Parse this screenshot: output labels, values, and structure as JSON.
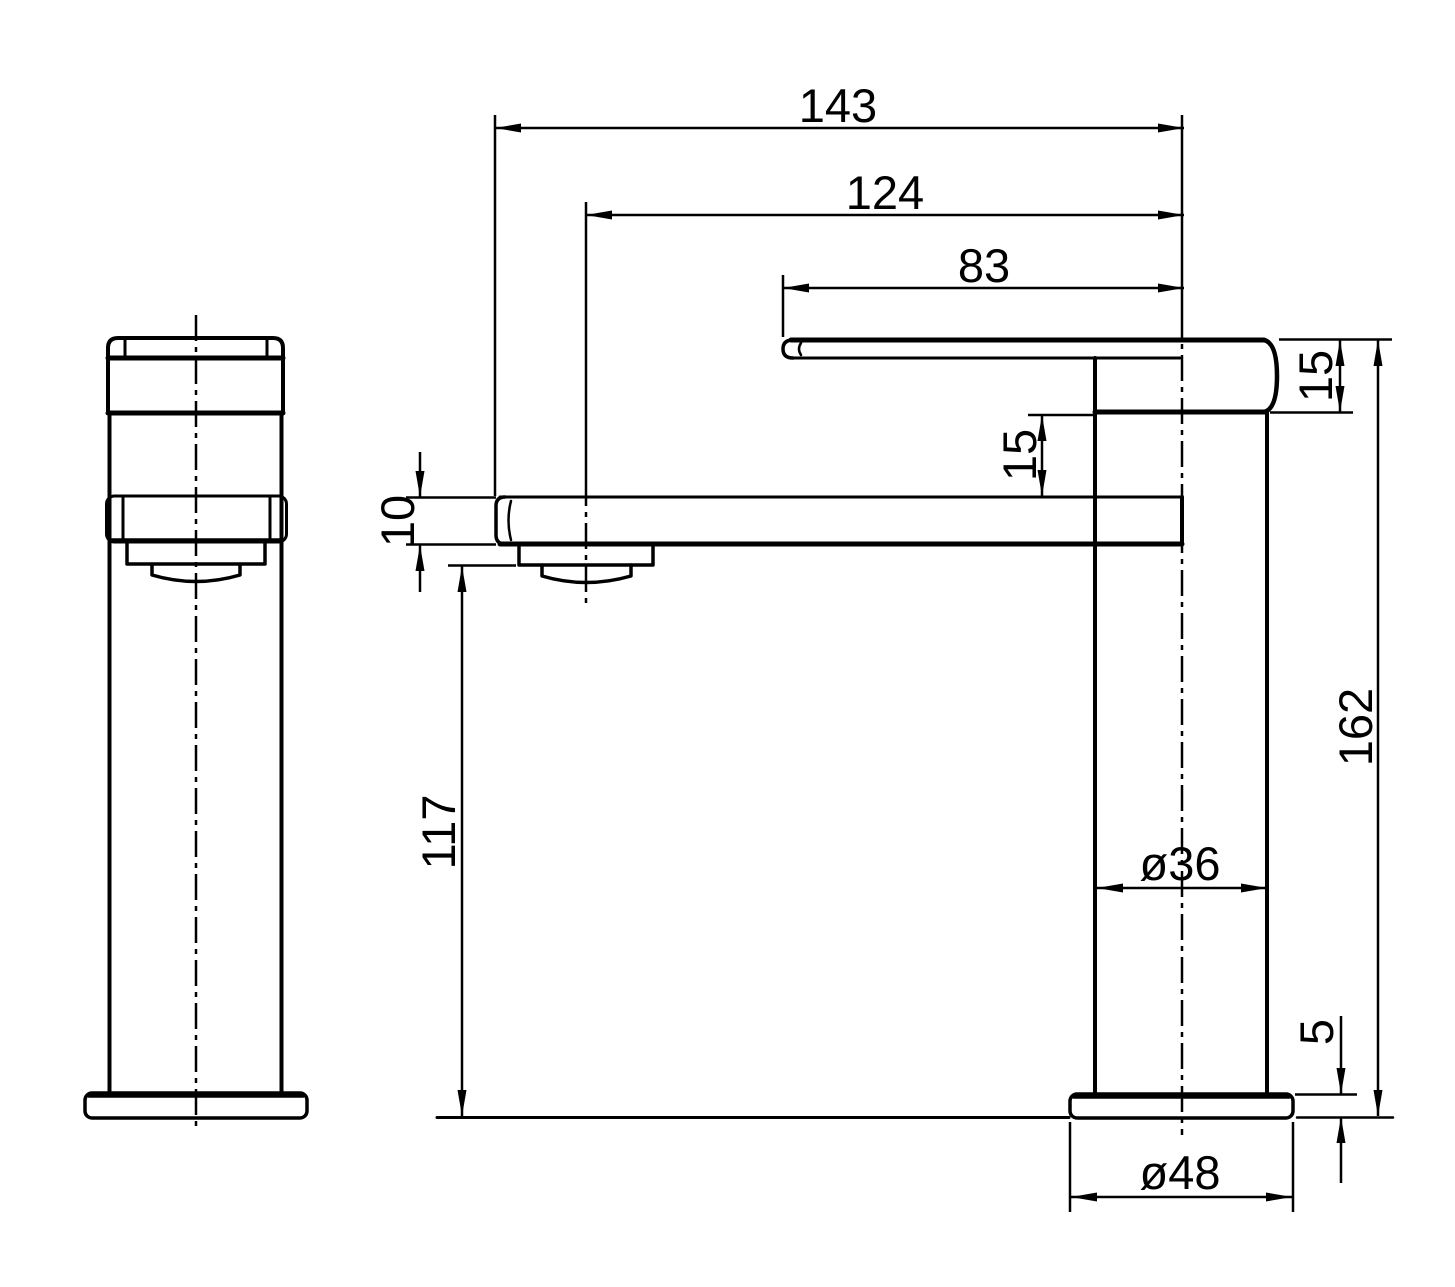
{
  "diagram": {
    "type": "technical-drawing",
    "subject": "basin mixer tap, two orthographic views with dimensions",
    "colors": {
      "line": "#000000",
      "background": "#ffffff"
    },
    "dims": {
      "reach_overall": "143",
      "reach_outlet": "124",
      "reach_handle": "83",
      "handle_thickness": "15",
      "gap_handle_spout": "15",
      "spout_thickness": "10",
      "clearance_under_spout": "117",
      "height_overall": "162",
      "body_diameter": "ø36",
      "base_height": "5",
      "base_diameter": "ø48"
    }
  }
}
